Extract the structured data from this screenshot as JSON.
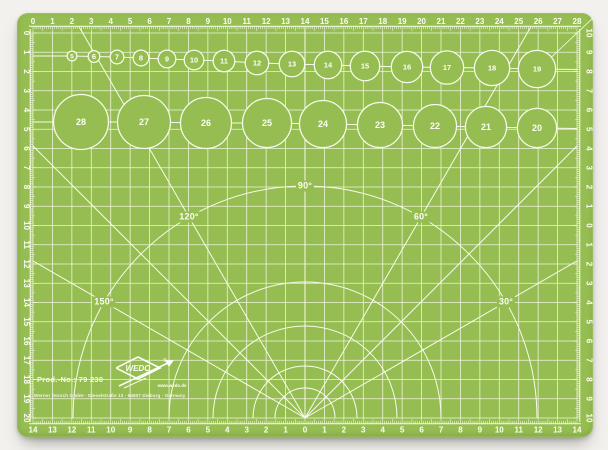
{
  "mat": {
    "colors": {
      "mat": "#95bd51",
      "grid_line": "#eef4da",
      "feature_line": "#f8fbec",
      "text": "#fdfef6",
      "background": "#f2f1ee"
    },
    "rulers": {
      "top": {
        "labels": [
          "0",
          "1",
          "2",
          "3",
          "4",
          "5",
          "6",
          "7",
          "8",
          "9",
          "10",
          "11",
          "12",
          "13",
          "14",
          "15",
          "16",
          "17",
          "18",
          "19",
          "20",
          "21",
          "22",
          "23",
          "24",
          "25",
          "26",
          "27",
          "28"
        ]
      },
      "left": {
        "labels": [
          "0",
          "1",
          "2",
          "3",
          "4",
          "5",
          "6",
          "7",
          "8",
          "9",
          "10",
          "11",
          "12",
          "13",
          "14",
          "15",
          "16",
          "17",
          "18",
          "19",
          "20"
        ]
      },
      "right": {
        "labels": [
          "10",
          "9",
          "8",
          "7",
          "6",
          "5",
          "4",
          "3",
          "2",
          "1",
          "0",
          "1",
          "2",
          "3",
          "4",
          "5",
          "6",
          "7",
          "8",
          "9",
          "10"
        ]
      },
      "bottom": {
        "labels": [
          "14",
          "13",
          "12",
          "11",
          "10",
          "9",
          "8",
          "7",
          "6",
          "5",
          "4",
          "3",
          "2",
          "1",
          "0",
          "1",
          "2",
          "3",
          "4",
          "5",
          "6",
          "7",
          "8",
          "9",
          "10",
          "11",
          "12",
          "13",
          "14"
        ]
      }
    },
    "circles": {
      "small_row": [
        {
          "n": "5",
          "x": 55,
          "y": 43
        },
        {
          "n": "6",
          "x": 77,
          "y": 43.5
        },
        {
          "n": "7",
          "x": 100,
          "y": 44
        },
        {
          "n": "8",
          "x": 124,
          "y": 45
        },
        {
          "n": "9",
          "x": 150,
          "y": 46
        },
        {
          "n": "10",
          "x": 177,
          "y": 47
        },
        {
          "n": "11",
          "x": 207,
          "y": 48
        },
        {
          "n": "12",
          "x": 240,
          "y": 50
        },
        {
          "n": "13",
          "x": 275,
          "y": 51
        },
        {
          "n": "14",
          "x": 311,
          "y": 52
        },
        {
          "n": "15",
          "x": 348,
          "y": 53
        },
        {
          "n": "16",
          "x": 390,
          "y": 54
        },
        {
          "n": "17",
          "x": 430,
          "y": 54.5
        },
        {
          "n": "18",
          "x": 475,
          "y": 55
        },
        {
          "n": "19",
          "x": 520,
          "y": 56
        }
      ],
      "large_row": [
        {
          "n": "28",
          "x": 64,
          "y": 109
        },
        {
          "n": "27",
          "x": 127,
          "y": 109
        },
        {
          "n": "26",
          "x": 189,
          "y": 110
        },
        {
          "n": "25",
          "x": 250,
          "y": 110
        },
        {
          "n": "24",
          "x": 306,
          "y": 111
        },
        {
          "n": "23",
          "x": 363,
          "y": 112
        },
        {
          "n": "22",
          "x": 418,
          "y": 113
        },
        {
          "n": "21",
          "x": 469,
          "y": 114
        },
        {
          "n": "20",
          "x": 520,
          "y": 115
        }
      ]
    },
    "angle_labels": [
      {
        "text": "90°",
        "x": 288,
        "y": 173
      },
      {
        "text": "120°",
        "x": 172,
        "y": 204
      },
      {
        "text": "60°",
        "x": 404,
        "y": 204
      },
      {
        "text": "150°",
        "x": 87,
        "y": 289
      },
      {
        "text": "30°",
        "x": 489,
        "y": 289
      }
    ],
    "arc_radii": [
      30,
      52,
      92,
      136,
      232
    ],
    "ray_angles_deg": [
      30,
      45,
      60,
      90,
      120,
      135,
      150
    ],
    "branding": {
      "prod_no": "Prod.-No.: 79 230",
      "company": "Werner Dorsch GmbH · Dieselstraße 13 · 64807 Dieburg · Germany",
      "brand": "WEDO",
      "reg": "®",
      "url": "www.wedo.de"
    }
  }
}
